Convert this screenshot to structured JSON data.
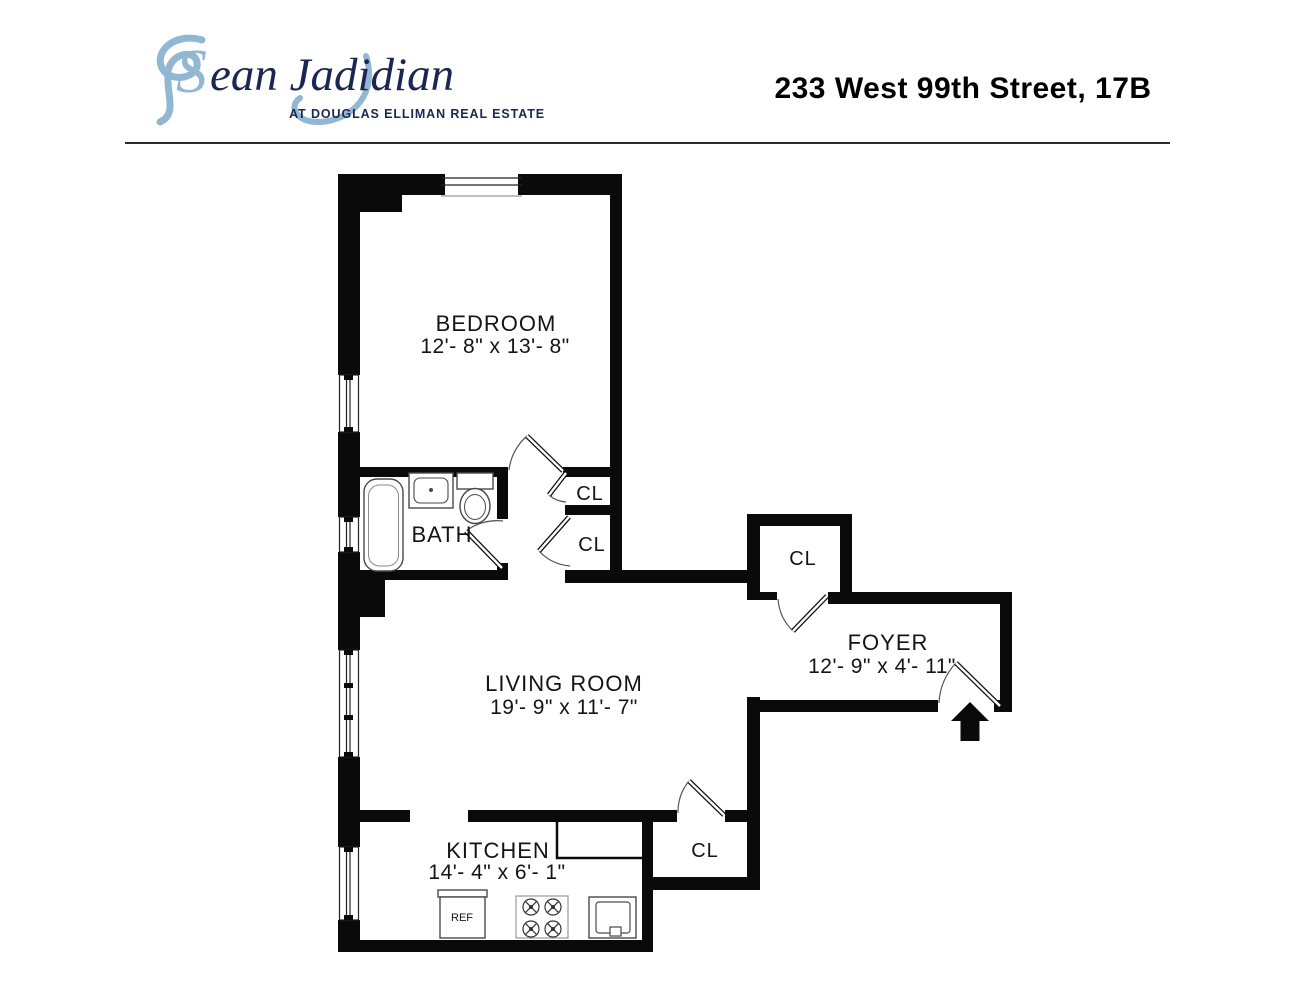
{
  "header": {
    "logo": {
      "name_initial": "S",
      "name_rest": "ean Jadidian",
      "name_full": "Sean Jadidian",
      "tagline": "AT DOUGLAS ELLIMAN REAL ESTATE",
      "accent_color": "#92b7d2",
      "navy_color": "#1b2753"
    },
    "address": "233 West 99th Street, 17B"
  },
  "floorplan": {
    "wall_color": "#0a0a0a",
    "closet_label": "CL",
    "rooms": {
      "bedroom": {
        "name": "BEDROOM",
        "dim": "12'- 8\" x 13'- 8\""
      },
      "bath": {
        "name": "BATH"
      },
      "living": {
        "name": "LIVING ROOM",
        "dim": "19'- 9\" x 11'- 7\""
      },
      "foyer": {
        "name": "FOYER",
        "dim": "12'- 9\" x 4'- 11\""
      },
      "kitchen": {
        "name": "KITCHEN",
        "dim": "14'- 4\" x 6'- 1\""
      }
    },
    "appliances": {
      "refrigerator": "REF"
    }
  }
}
